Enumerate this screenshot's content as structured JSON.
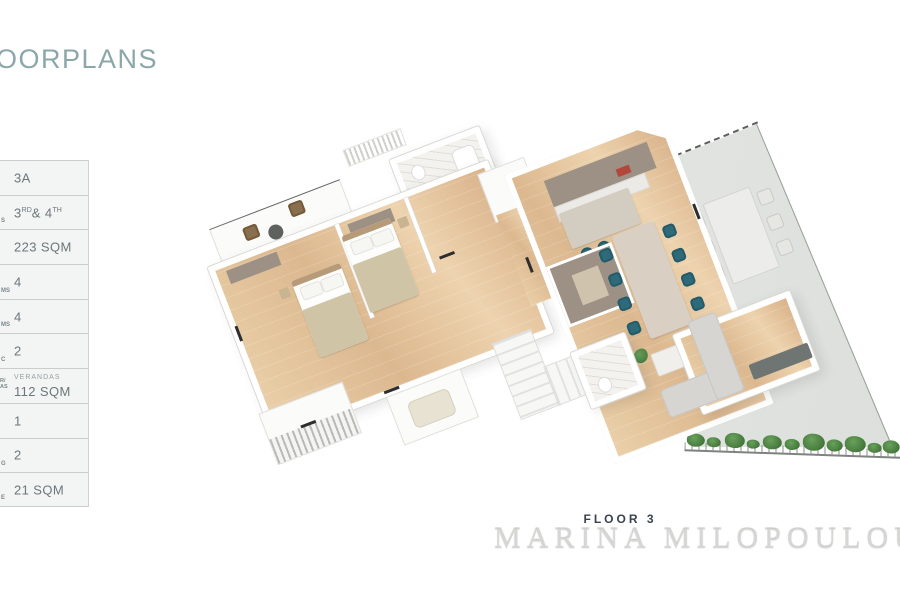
{
  "header": {
    "title": "OORPLANS"
  },
  "spec_table": {
    "rows": [
      {
        "value": "3A",
        "fragment": ""
      },
      {
        "parts": {
          "base1": "3",
          "sup1": "RD",
          "base2": "& 4",
          "sup2": "TH"
        },
        "fragment": "S"
      },
      {
        "value": "223 SQM",
        "fragment": ""
      },
      {
        "value": "4",
        "fragment": "MS"
      },
      {
        "value": "4",
        "fragment": "MS"
      },
      {
        "value": "2",
        "fragment": "C"
      },
      {
        "label": "VERANDAS",
        "value": "112 SQM",
        "fragment_top": "R/",
        "fragment_bottom": "AS"
      },
      {
        "value": "1",
        "fragment": ""
      },
      {
        "value": "2",
        "fragment": "G"
      },
      {
        "value": "21 SQM",
        "fragment": "E"
      }
    ]
  },
  "footer": {
    "floor_label": "FLOOR 3",
    "watermark": "MARINA MILOPOULOU"
  },
  "colors": {
    "title_teal": "#8BA7AA",
    "seat_teal": "#2E6B7A",
    "wood_floor": "#E4C29C",
    "veranda_tile": "#DCE0DC",
    "plant_green": "#4E8749",
    "watermark_gray": "#D6D6D4",
    "floor_label_dark": "#39424E",
    "table_text": "#6C777B",
    "table_row_bg": "#F3F4F4"
  }
}
